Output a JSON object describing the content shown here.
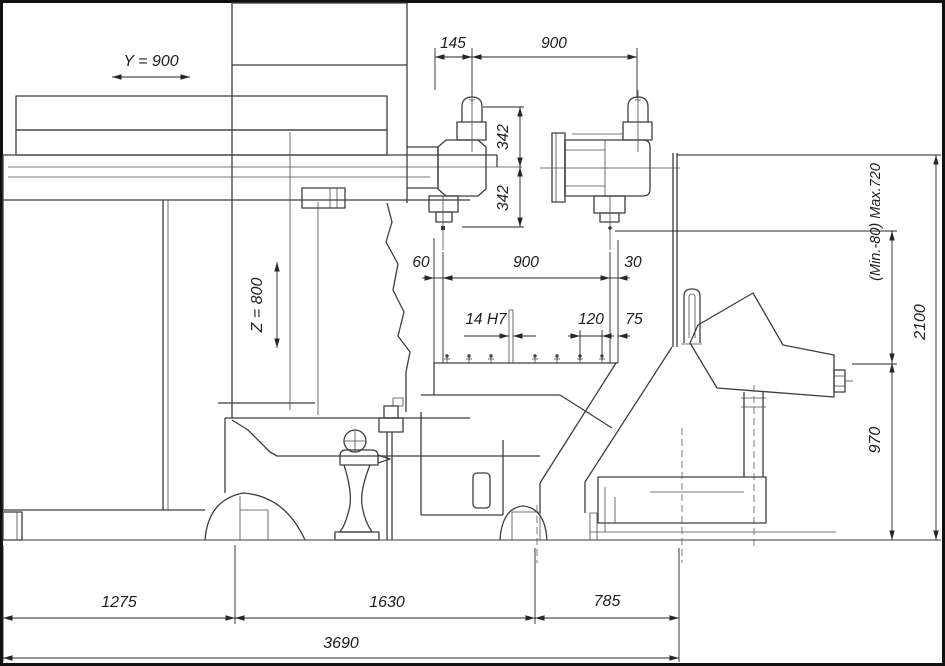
{
  "drawing": {
    "type": "technical-drawing",
    "view": "machine-side-elevation",
    "colors": {
      "line": "#3d3d3d",
      "dim": "#262626",
      "background": "#ffffff",
      "frame": "#101010"
    },
    "labels": {
      "y_travel": "Y = 900",
      "z_travel": "Z = 800"
    },
    "dims": {
      "top": {
        "offset": "145",
        "spindle_spacing": "900"
      },
      "spindle": {
        "upper": "342",
        "lower": "342"
      },
      "table": {
        "left": "60",
        "center": "900",
        "right": "30"
      },
      "slots": {
        "width": "14 H7",
        "pitch": "120",
        "edge": "75"
      },
      "right": {
        "range": "(Min.-80) Max.720",
        "total": "2100",
        "table_height": "970"
      },
      "bottom": {
        "left": "1275",
        "center": "1630",
        "right": "785",
        "overall": "3690"
      }
    }
  }
}
